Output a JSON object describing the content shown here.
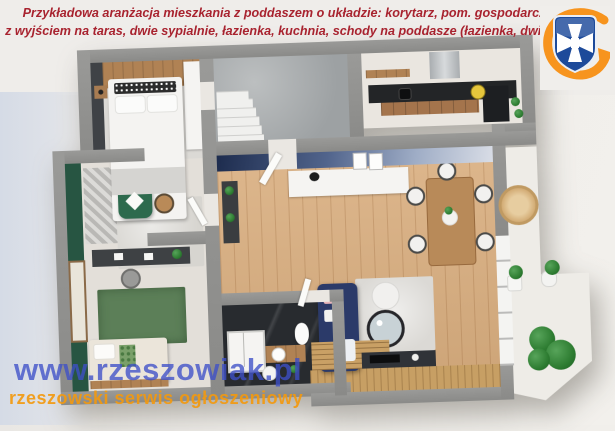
{
  "header": {
    "line1": "Przykładowa aranżacja mieszkania z poddaszem o układzie:  korytarz, pom. gospodarcze, salon",
    "line2": "z wyjściem na taras, dwie sypialnie, łazienka, kuchnia, schody na poddasze (łazienka, dwie sypialnie)",
    "text_color": "#a8232f"
  },
  "logo": {
    "name": "rzeszowiak-shield-logo",
    "shield_color": "#1d4a9a",
    "cross_color": "#ffffff",
    "swoosh_color": "#f7941e"
  },
  "watermark": {
    "site": "www.rzeszowiak.pl",
    "tagline": "rzeszowski serwis ogłoszeniowy",
    "site_color": "#3e50c8",
    "tagline_color": "#f2990f"
  },
  "floorplan": {
    "type": "3d-top-down-apartment-render",
    "wall_color": "#8f8f8d",
    "rooms": [
      {
        "id": "bedroom-1",
        "palette": [
          "#3f4246",
          "#b08254",
          "#f4f3f1"
        ]
      },
      {
        "id": "utility-stairs-room",
        "palette": [
          "#a8acad",
          "#f0f0ee"
        ]
      },
      {
        "id": "kitchen",
        "palette": [
          "#232527",
          "#a4744c",
          "#e6c63c"
        ]
      },
      {
        "id": "living-dining-room",
        "palette": [
          "#d8ad7e",
          "#1d2c4e",
          "#b88a59"
        ]
      },
      {
        "id": "bedroom-2",
        "palette": [
          "#275542",
          "#5c7f58",
          "#ebe5da"
        ]
      },
      {
        "id": "bathroom",
        "palette": [
          "#282b2f",
          "#fbfbfa"
        ]
      },
      {
        "id": "living-room-salon",
        "palette": [
          "#2b3a69",
          "#dbd9d5",
          "#303338"
        ]
      },
      {
        "id": "terrace",
        "palette": [
          "#edebe6",
          "#2e7d32",
          "#c79f64"
        ]
      }
    ]
  }
}
